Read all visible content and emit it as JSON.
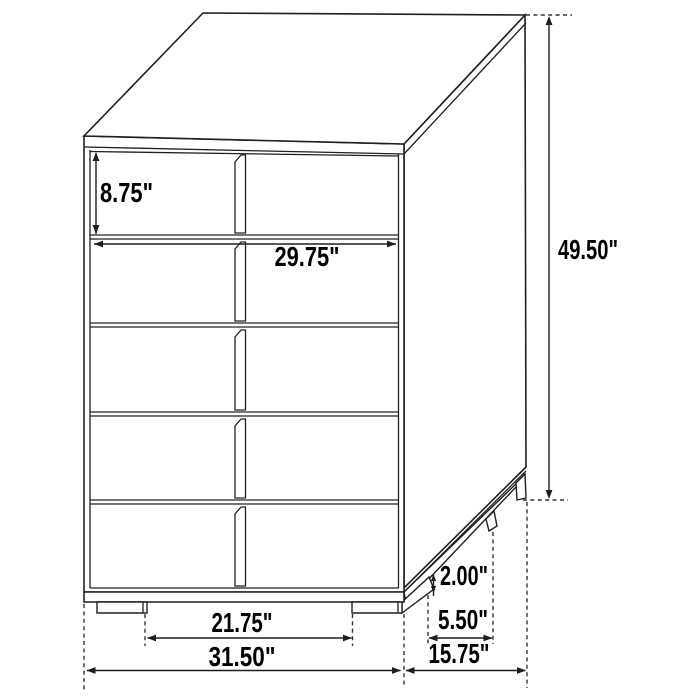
{
  "canvas": {
    "width": 700,
    "height": 700,
    "background": "#ffffff"
  },
  "drawing": {
    "subject": "five-drawer-chest-dimension-diagram",
    "drawer_count": 5,
    "colors": {
      "line": "#202020",
      "dimension_line": "#1e1e1e",
      "extension_line": "#333333",
      "text": "#000000",
      "fill": "#ffffff"
    }
  },
  "dimensions": {
    "drawer_height": {
      "label": "8.75\""
    },
    "drawer_width": {
      "label": "29.75\""
    },
    "overall_height": {
      "label": "49.50\""
    },
    "leg_height": {
      "label": "2.00\""
    },
    "leg_spacing_depth": {
      "label": "5.50\""
    },
    "overall_depth": {
      "label": "15.75\""
    },
    "leg_spacing_width": {
      "label": "21.75\""
    },
    "overall_width": {
      "label": "31.50\""
    }
  }
}
